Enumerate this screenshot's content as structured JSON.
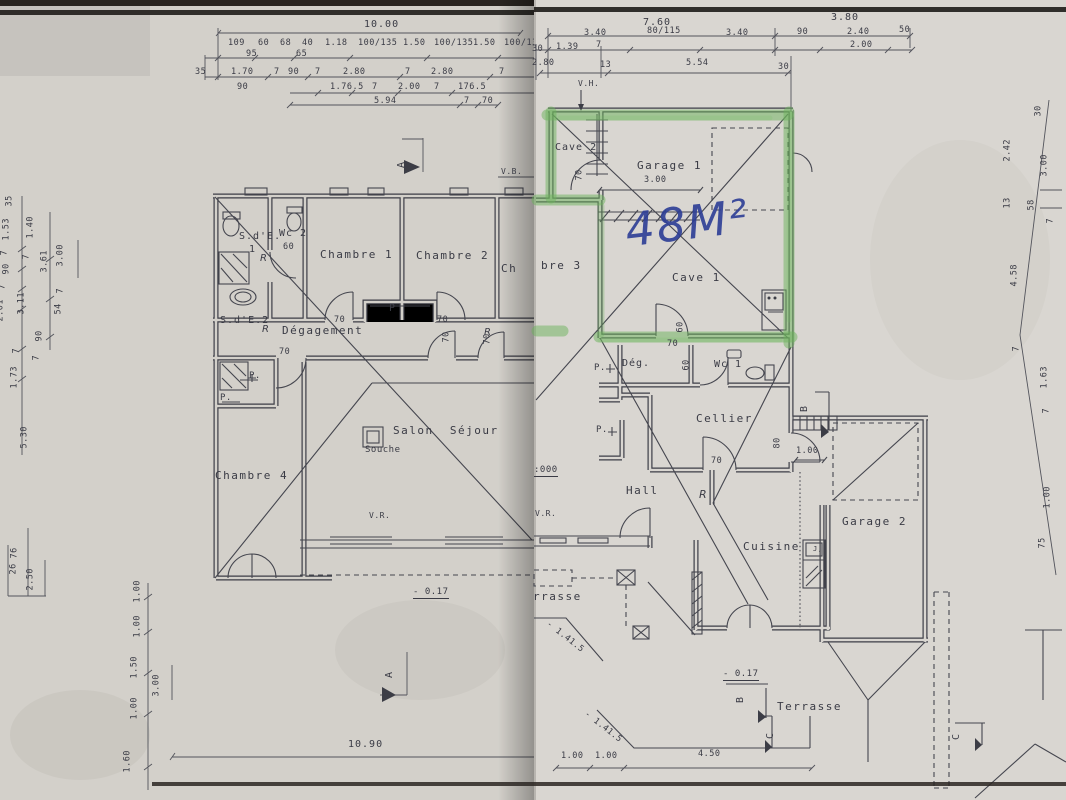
{
  "sheet_left": {
    "top_dims": {
      "total": "10.00",
      "row1": [
        "109",
        "60",
        "68",
        "40",
        "1.18",
        "100/135",
        "1.50",
        "100/135",
        "1.50",
        "100/135"
      ],
      "row1_sub": [
        "95",
        "65"
      ],
      "row2": [
        "35",
        "1.70",
        "7",
        "90",
        "7",
        "2.80",
        "7",
        "2.80",
        "7"
      ],
      "row3": [
        "90",
        "1.76.5",
        "7",
        "2.00",
        "7",
        "176.5"
      ],
      "row4": [
        "5.94",
        "7",
        "70"
      ]
    },
    "left_dims": [
      "35",
      "1.53",
      "1.40",
      "7",
      "7",
      "90",
      "3.61",
      "3.00",
      "7",
      "3.11",
      "2.01",
      "54",
      "7",
      "90",
      "7",
      "7",
      "1.19",
      "1.73",
      "5.30",
      "1.00",
      "76",
      "26",
      "2.50",
      "1.00",
      "1.00",
      "1.50",
      "3.00",
      "1.00",
      "1.60"
    ],
    "bottom_dim": "10.90",
    "rooms": {
      "sde1_line1": "S.d'E.",
      "sde1_line2": "1",
      "wc2": "Wc 2",
      "chambre1": "Chambre 1",
      "chambre2": "Chambre 2",
      "chambre3_partial": "Ch",
      "sde2": "S.d'E.2",
      "degagement": "Dégagement",
      "chambre4": "Chambre 4",
      "salon": "Salon  Séjour",
      "souche": "Souche"
    },
    "labels": {
      "placard": "P",
      "placard_dot": "P.",
      "vr": "V.R.",
      "level": "- 0.17",
      "vb": "V.B.",
      "section_a": "A",
      "radiator": "R",
      "door60": "60",
      "door70": "70"
    }
  },
  "sheet_right": {
    "top_dims": {
      "total_left": "7.60",
      "total_right": "3.80",
      "row2": [
        "3.40",
        "80/115",
        "3.40",
        "90",
        "2.40",
        "50"
      ],
      "row2_sub": "2.00",
      "row3": [
        "30",
        "1.39",
        "7"
      ],
      "row4": [
        "2.80",
        "13",
        "5.54",
        "30"
      ]
    },
    "right_dims": [
      "30",
      "2.42",
      "3.00",
      "13",
      "58",
      "7",
      "4.58",
      "7",
      "1.63",
      "7",
      "1.00",
      "75"
    ],
    "bottom_dims": [
      "1.00",
      "1.00",
      "4.50"
    ],
    "rooms": {
      "cave2": "Cave 2",
      "garage1": "Garage 1",
      "cave1": "Cave 1",
      "deg": "Dég.",
      "wc1": "Wc 1",
      "cellier": "Cellier",
      "hall": "Hall",
      "cuisine": "Cuisine",
      "garage2": "Garage 2",
      "terrasse": "Terrasse",
      "terrasse_partial": "rrasse",
      "chambre3_partial": "bre 3"
    },
    "labels": {
      "handwritten_area": "48M²",
      "vh": "V.H.",
      "section_b": "B",
      "section_c": "C",
      "radiator": "R",
      "placard": "P.",
      "level": "- 0.17",
      "level_zero": ":000",
      "vr": "V.R.",
      "garage1_width": "3.00",
      "door70": "70",
      "door60": "60",
      "door80": "80",
      "door100": "1.00",
      "sink": "J,",
      "boundary": "- 1.41.5"
    }
  }
}
